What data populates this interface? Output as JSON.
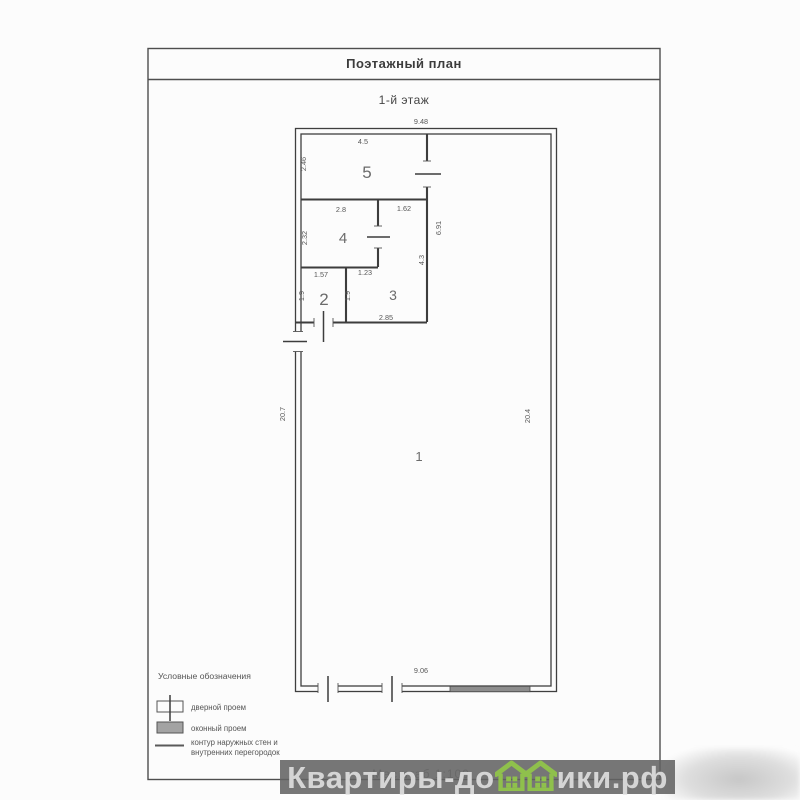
{
  "document": {
    "title": "Поэтажный план",
    "floor_label": "1-й этаж",
    "scale_note": "Масштаб 1:100"
  },
  "plan": {
    "room_labels": {
      "r1": "1",
      "r2": "2",
      "r3": "3",
      "r4": "4",
      "r5": "5"
    },
    "dims": {
      "overall_width_top": "9.48",
      "room5_width": "4.5",
      "room5_depth": "2.46",
      "room4_width": "2.8",
      "hall_width": "1.62",
      "room4_depth": "2.32",
      "right_section_depth": "6.91",
      "room3_depth_right": "4.3",
      "room2_width": "1.57",
      "room3_width_top": "1.23",
      "room2_depth": "1.9",
      "room3_depth": "1.9",
      "room3_width_bottom": "2.85",
      "left_height": "20.7",
      "right_height": "20.4",
      "inner_width_bottom": "9.06"
    }
  },
  "legend": {
    "title": "Условные обозначения",
    "door_label": "дверной проем",
    "window_label": "оконный проем",
    "wall_label_line1": "контур наружных стен и",
    "wall_label_line2": "внутренних перегородок"
  },
  "watermark": {
    "text_left": "Квартиры-до",
    "text_right": "ики.рф"
  },
  "colors": {
    "house_green": "#8fc04c",
    "watermark_bar": "#636363",
    "watermark_text": "#d5d5d5",
    "ink": "#3f3f3f"
  }
}
